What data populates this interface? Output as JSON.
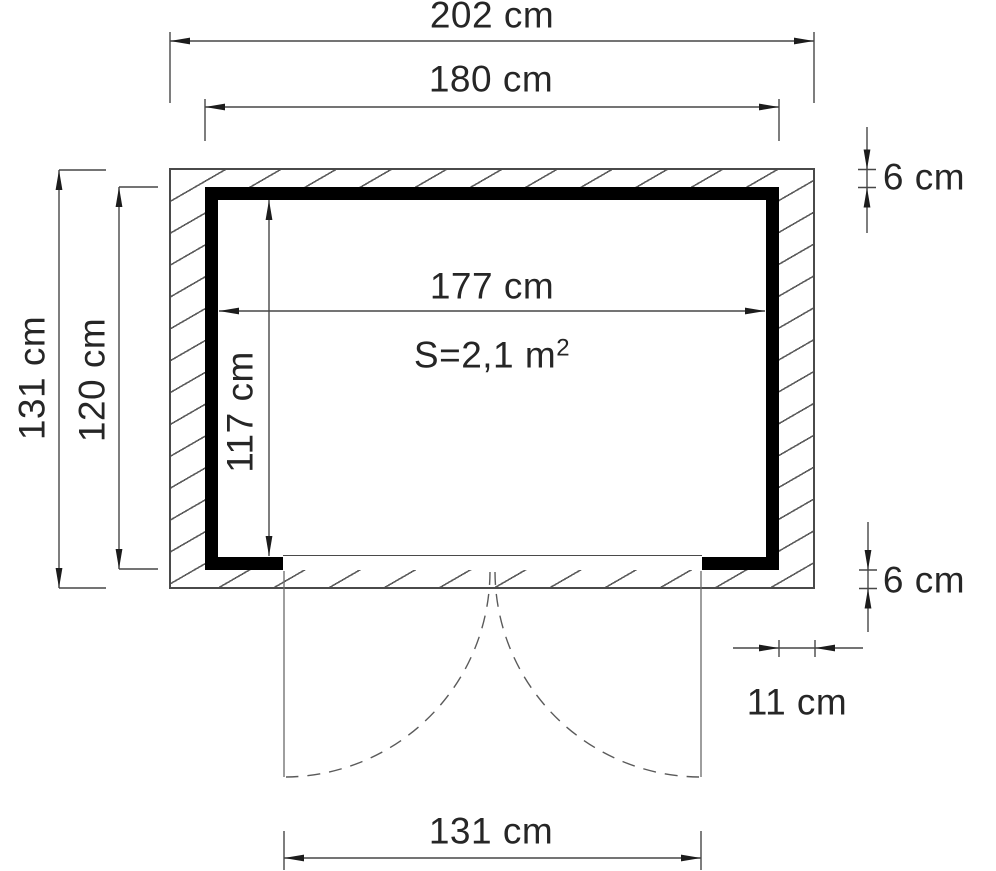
{
  "plan": {
    "area": {
      "base": "S=2,1 m",
      "sup": "2"
    },
    "dims": {
      "overall_width": "202 cm",
      "body_width": "180 cm",
      "interior_width": "177 cm",
      "overall_depth": "131 cm",
      "body_depth": "120 cm",
      "interior_depth": "117 cm",
      "overhang_top": "6 cm",
      "overhang_bottom": "6 cm",
      "overhang_side": "11 cm",
      "door_width": "131 cm"
    }
  }
}
